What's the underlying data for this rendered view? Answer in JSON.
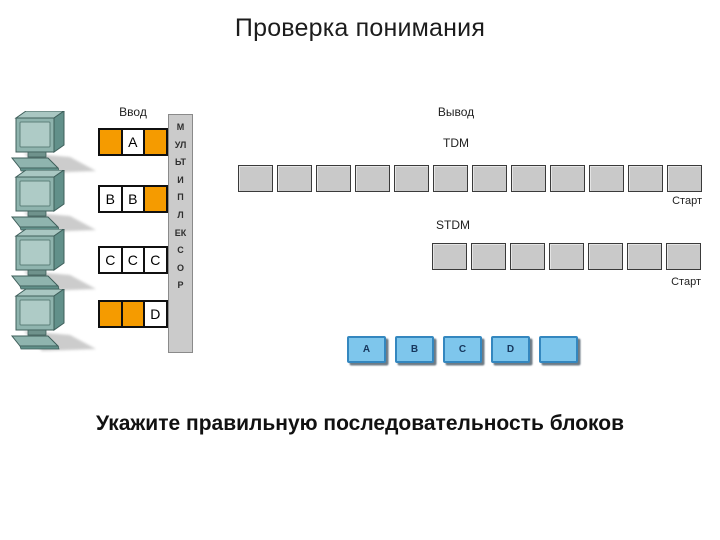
{
  "slide": {
    "title": "Проверка понимания",
    "question": "Укажите правильную последовательность блоков"
  },
  "diagram": {
    "input_label": "Ввод",
    "output_label": "Вывод",
    "multiplexer_label": "МУЛЬТИПЛЕКСОР",
    "computer_count": 4,
    "input_rows": [
      {
        "cells": [
          {
            "type": "orange",
            "label": ""
          },
          {
            "type": "white",
            "label": "A"
          },
          {
            "type": "orange",
            "label": ""
          }
        ]
      },
      {
        "cells": [
          {
            "type": "white",
            "label": "B"
          },
          {
            "type": "white",
            "label": "B"
          },
          {
            "type": "orange",
            "label": ""
          }
        ]
      },
      {
        "cells": [
          {
            "type": "white",
            "label": "C"
          },
          {
            "type": "white",
            "label": "C"
          },
          {
            "type": "white",
            "label": "C"
          }
        ]
      },
      {
        "cells": [
          {
            "type": "orange",
            "label": ""
          },
          {
            "type": "orange",
            "label": ""
          },
          {
            "type": "white",
            "label": "D"
          }
        ]
      }
    ],
    "tdm": {
      "label": "TDM",
      "slot_count": 12,
      "start_label": "Старт"
    },
    "stdm": {
      "label": "STDM",
      "slot_count": 7,
      "start_label": "Старт"
    },
    "answer_blocks": [
      {
        "label": "A"
      },
      {
        "label": "B"
      },
      {
        "label": "C"
      },
      {
        "label": "D"
      },
      {
        "label": ""
      }
    ]
  },
  "colors": {
    "cell_orange": "#f59b00",
    "cell_white": "#ffffff",
    "slot_gray": "#c9c9c9",
    "slot_border": "#3a3a3a",
    "mux_gray": "#cbcbcb",
    "answer_blue": "#7ec6ec",
    "answer_border": "#3487bf",
    "computer_teal": "#8fb4ae"
  }
}
